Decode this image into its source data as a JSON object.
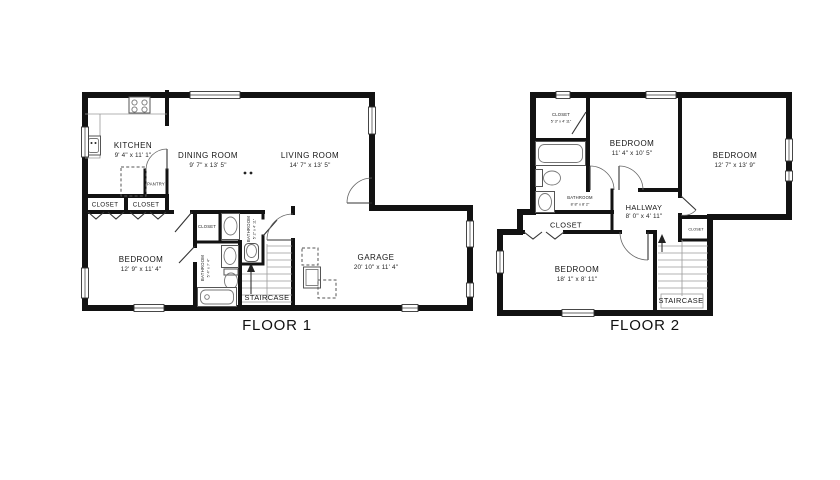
{
  "canvas": {
    "background": "#ffffff",
    "wall_color": "#121212",
    "line_color": "#9a9a9a"
  },
  "floor1": {
    "title": "FLOOR 1",
    "rooms": {
      "kitchen": {
        "name": "KITCHEN",
        "dims": "9' 4\" x 11' 1\""
      },
      "dining_room": {
        "name": "DINING ROOM",
        "dims": "9' 7\" x 13' 5\""
      },
      "living_room": {
        "name": "LIVING ROOM",
        "dims": "14' 7\" x 13' 5\""
      },
      "bedroom": {
        "name": "BEDROOM",
        "dims": "12' 9\" x 11' 4\""
      },
      "garage": {
        "name": "GARAGE",
        "dims": "20' 10\" x 11' 4\""
      },
      "pantry": {
        "name": "PANTRY"
      },
      "closet_a": {
        "name": "CLOSET"
      },
      "closet_b": {
        "name": "CLOSET"
      },
      "closet_hall": {
        "name": "CLOSET"
      },
      "bathroom_a": {
        "name": "BATHROOM",
        "dims": "5' 2\" x 4' 11\""
      },
      "bathroom_b": {
        "name": "BATHROOM",
        "dims": "5' 4\" x 7' 4\""
      },
      "staircase": {
        "name": "STAIRCASE"
      }
    }
  },
  "floor2": {
    "title": "FLOOR 2",
    "rooms": {
      "closet_top": {
        "name": "CLOSET",
        "dims": "5' 3\" x 4' 11\""
      },
      "bedroom_mid": {
        "name": "BEDROOM",
        "dims": "11' 4\" x 10' 5\""
      },
      "bedroom_right": {
        "name": "BEDROOM",
        "dims": "12' 7\" x 13' 9\""
      },
      "bathroom": {
        "name": "BATHROOM",
        "dims": "8' 8\" x 8' 2\""
      },
      "hallway": {
        "name": "HALLWAY",
        "dims": "8' 0\" x 4' 11\""
      },
      "closet_wide": {
        "name": "CLOSET"
      },
      "closet_stairs": {
        "name": "CLOSET"
      },
      "bedroom_bottom": {
        "name": "BEDROOM",
        "dims": "18' 1\" x 8' 11\""
      },
      "staircase": {
        "name": "STAIRCASE"
      }
    }
  }
}
